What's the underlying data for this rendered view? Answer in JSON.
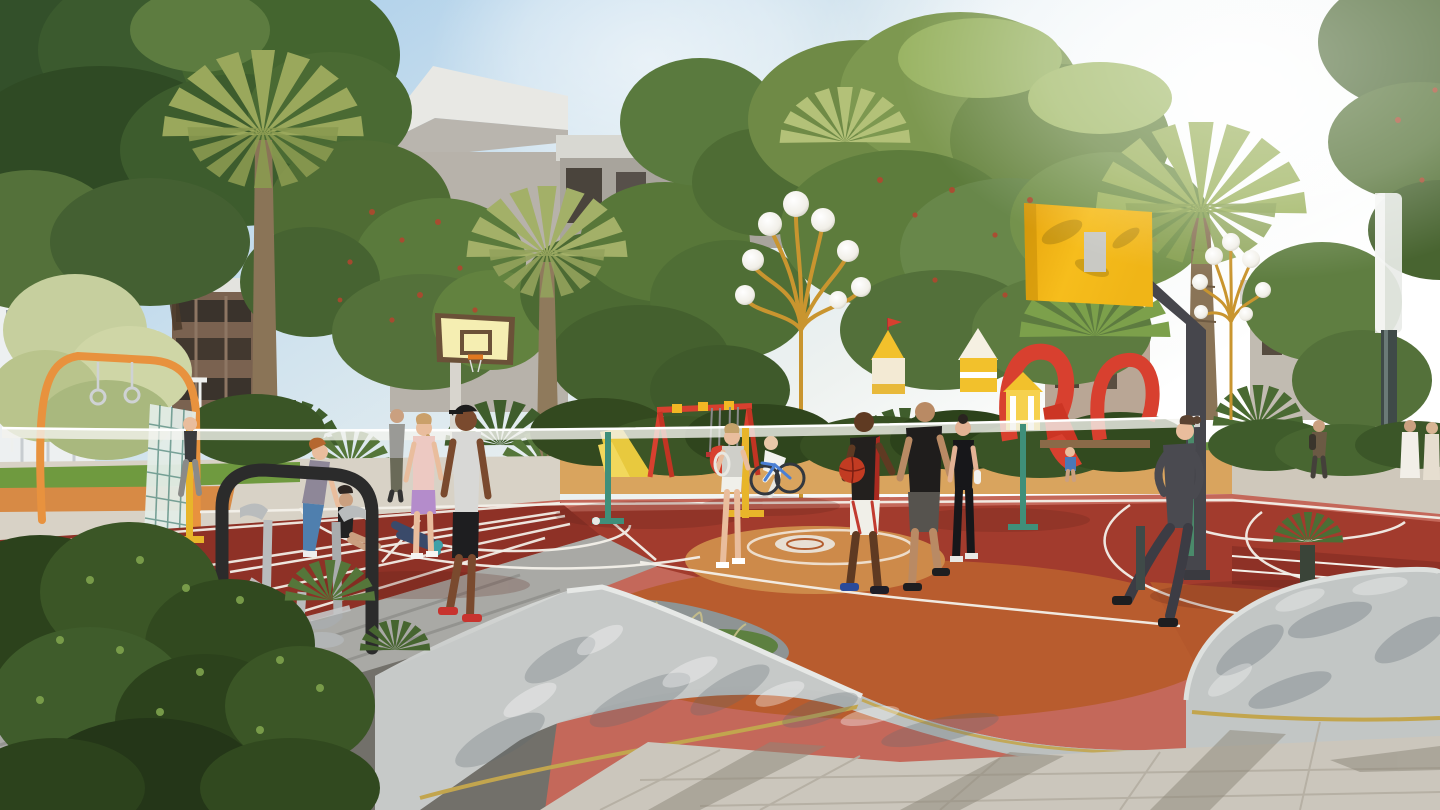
{
  "scene": {
    "title": "Sunny community sports park rendering with basketball court, badminton net, playground and jogging residents",
    "type": "architectural-visualization",
    "time_of_day": "bright sunny daytime",
    "weather": "clear sky with strong sun glare at upper right"
  },
  "palette": {
    "sky_top": "#9cc6e8",
    "sky_mid": "#d9e8f0",
    "sky_glow": "#ffffff",
    "canopy_dark": "#3d5a2d",
    "canopy_mid": "#5d7c3c",
    "canopy_light": "#8fae58",
    "canopy_pale": "#c6cf9e",
    "palm_frond": "#a0b060",
    "palm_trunk": "#8a7457",
    "berry_red": "#b5452e",
    "building_white": "#edf0f1",
    "building_pink": "#e9c9c2",
    "building_brown": "#7a6250",
    "building_gray": "#b7b2aa",
    "roof_white": "#e8e8e4",
    "lamp_gold": "#c9952f",
    "globe_white": "#f6f4ee",
    "board_yellow": "#f0b517",
    "board_pale": "#f5eeb2",
    "board_trim": "#6b5138",
    "pole_dark": "#46464c",
    "pole_light": "#d8d5ce",
    "court_red": "#a23b2d",
    "court_pink": "#c4685a",
    "court_orange": "#b85c2e",
    "court_tan": "#cd8a4a",
    "track_red": "#8e3126",
    "line_white": "#f4f1ea",
    "net_white": "#f2f2ee",
    "play_red": "#d8402f",
    "play_yellow": "#f2c12c",
    "play_cream": "#f3ead4",
    "wall_concrete": "#c6c9c8",
    "wall_inner": "#8e9494",
    "gold_trim": "#c2a54e",
    "pave_light": "#cbc6bc",
    "asphalt": "#72706a",
    "steps_gray": "#a9a9a5",
    "grass_green": "#6f9a3f",
    "bush_dark": "#31491f",
    "skin_dark": "#7a4a2e",
    "skin_light": "#e9bd9d",
    "machine_black": "#2b2b2b",
    "machine_gray": "#b9bcbd"
  },
  "objects": [
    "multi-colored basketball court with white markings",
    "badminton net stretched across court",
    "yellow basketball backboard on dark cantilever pole (right)",
    "pale yellow basketball backboard on white pole (left)",
    "running track lanes with white lines (lower left)",
    "golden multi-globe decorative lamp posts",
    "tall modern lamp with frosted diffuser (far right)",
    "children playground with castle towers and red slides",
    "red swing set with yellow joints",
    "orange calisthenics arch with gym rings and climbing net",
    "outdoor air-walker exercise machine",
    "curved concrete planter walls with brass trim",
    "townhouses behind dense trees",
    "palm trees and tropical shrubs",
    "paved plaza with long tree shadows"
  ],
  "figures": [
    {
      "id": "jogger-left",
      "description": "man jogging past climbing frame",
      "colors": "dark top, gray pants"
    },
    {
      "id": "woman-bending",
      "description": "red-haired woman stretching",
      "colors": "gray top, teal leggings"
    },
    {
      "id": "woman-sitting",
      "description": "woman sitting on court",
      "colors": "black sportswear"
    },
    {
      "id": "person-lying",
      "description": "person lying stretching legs",
      "colors": "dark leggings, teal shoes"
    },
    {
      "id": "woman-pink",
      "description": "standing woman",
      "colors": "pink top, lavender shorts"
    },
    {
      "id": "man-cap",
      "description": "walking man with cap",
      "colors": "black cap, white tank, black shorts, red shoes"
    },
    {
      "id": "man-gray-back",
      "description": "man walking behind group",
      "colors": "gray top, olive pants"
    },
    {
      "id": "girl-racket",
      "description": "girl holding badminton racket",
      "colors": "gray tee, white shorts"
    },
    {
      "id": "cyclist",
      "description": "person riding bicycle",
      "colors": "white outfit, blue bike"
    },
    {
      "id": "player-ball",
      "description": "basketball player dribbling",
      "colors": "black-red jersey, white shorts"
    },
    {
      "id": "player-black-tee",
      "description": "basketball player",
      "colors": "black tee, gray shorts"
    },
    {
      "id": "woman-black",
      "description": "woman walking with bottle",
      "colors": "black top and leggings"
    },
    {
      "id": "jogger-right",
      "description": "woman jogging by planter",
      "colors": "dark gray sweater and leggings"
    },
    {
      "id": "man-backpack",
      "description": "man strolling on walkway",
      "colors": "brown jacket, backpack"
    },
    {
      "id": "strollers-white",
      "description": "pair walking in light dresses",
      "colors": "white and cream"
    },
    {
      "id": "child-playground",
      "description": "child near playhouse",
      "colors": "blue shirt"
    }
  ]
}
